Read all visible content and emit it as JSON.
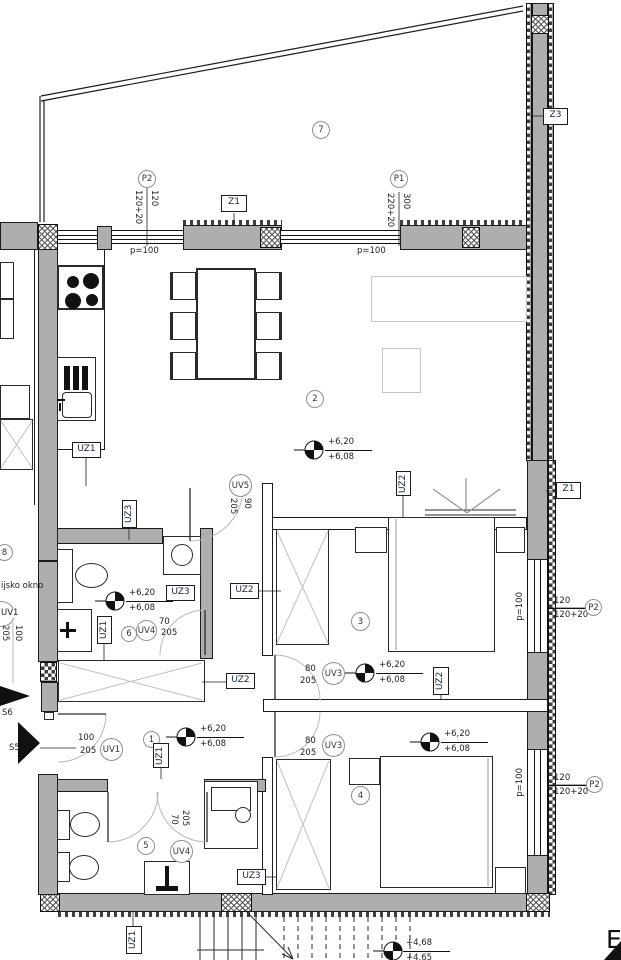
{
  "rooms": {
    "hall": "1",
    "living": "2",
    "bedA": "3",
    "bedB": "4",
    "bathA": "5",
    "bathB": "6",
    "terrace": "7",
    "neighbor": "8"
  },
  "levels": {
    "up": "+6,20",
    "low": "+6,08",
    "stairUp": "+4,68",
    "stairLow": "+4,65"
  },
  "openings": {
    "p1": {
      "id": "P1",
      "w": "300",
      "par": "220+20"
    },
    "p2": {
      "id": "P2",
      "w": "120",
      "par": "120+20"
    },
    "z1": "Z1",
    "z3": "Z3",
    "parapet": "p=100"
  },
  "walls": {
    "uz1": "UZ1",
    "uz2": "UZ2",
    "uz3": "UZ3"
  },
  "doors": {
    "uv1": {
      "id": "UV1",
      "w": "100",
      "h": "205"
    },
    "uv3": {
      "id": "UV3",
      "w": "80",
      "h": "205"
    },
    "uv4": {
      "id": "UV4",
      "w": "70",
      "h": "205"
    },
    "uv5": {
      "id": "UV5",
      "w": "90",
      "h": "205"
    }
  },
  "sections": {
    "s5": "S5",
    "s6": "S6"
  },
  "notes": {
    "windowNote": "ijsko okno",
    "cornerLetter": "E"
  },
  "colors": {
    "wall": "#aeaeae",
    "line": "#1c1c1c",
    "accentLight": "#c6c6c6"
  }
}
